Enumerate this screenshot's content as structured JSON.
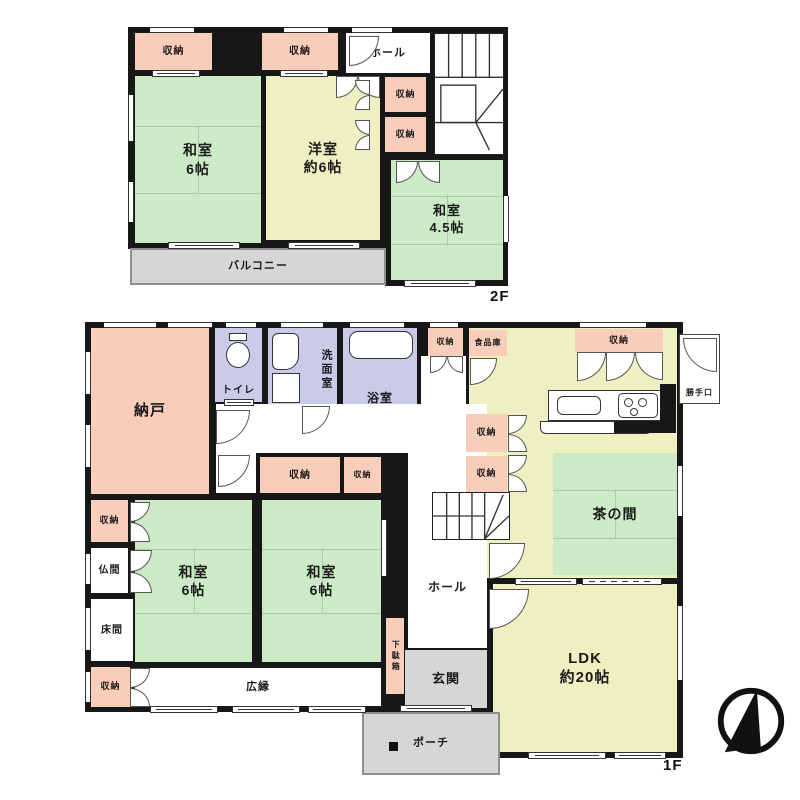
{
  "title": "2階建て住宅 間取り図",
  "colors": {
    "pink": "#f8cdb9",
    "green": "#cdeac6",
    "yellow": "#eef0c1",
    "lav": "#c9cbe9",
    "gray": "#d6d6d6",
    "white": "#ffffff",
    "wall": "#171717"
  },
  "floors": [
    {
      "id": "2f",
      "floor_label": "2F",
      "label_pos": {
        "x": 490,
        "y": 288
      },
      "body": [
        [
          128,
          27,
          380,
          222
        ],
        [
          385,
          27,
          123,
          259
        ]
      ],
      "rooms": [
        {
          "name": "closet",
          "label": "収納",
          "fill": "pink",
          "x": 135,
          "y": 33,
          "w": 77,
          "h": 37,
          "fs": 10
        },
        {
          "name": "closet",
          "label": "収納",
          "fill": "pink",
          "x": 262,
          "y": 33,
          "w": 76,
          "h": 37,
          "fs": 10
        },
        {
          "name": "hall",
          "label": "ホール",
          "fill": "white",
          "x": 346,
          "y": 33,
          "w": 84,
          "h": 40,
          "fs": 11
        },
        {
          "name": "closet",
          "label": "収納",
          "fill": "pink",
          "x": 385,
          "y": 77,
          "w": 41,
          "h": 35,
          "fs": 9
        },
        {
          "name": "closet",
          "label": "収納",
          "fill": "pink",
          "x": 385,
          "y": 117,
          "w": 41,
          "h": 35,
          "fs": 9
        },
        {
          "name": "tatami-room-6",
          "label": "和室",
          "label2": "6帖",
          "fill": "green",
          "x": 135,
          "y": 76,
          "w": 126,
          "h": 167,
          "fs": 14,
          "mats": true
        },
        {
          "name": "western-room-6",
          "label": "洋室",
          "label2": "約6帖",
          "fill": "yellow",
          "x": 266,
          "y": 76,
          "w": 114,
          "h": 164,
          "fs": 14
        },
        {
          "name": "tatami-room-4-5",
          "label": "和室",
          "label2": "4.5帖",
          "fill": "green",
          "x": 391,
          "y": 160,
          "w": 112,
          "h": 120,
          "fs": 13,
          "mats": true
        },
        {
          "name": "balcony",
          "label": "バルコニー",
          "fill": "gray",
          "x": 130,
          "y": 248,
          "w": 256,
          "h": 37,
          "fs": 11,
          "thin": true
        }
      ],
      "fixtures": [
        [
          "stairs",
          434,
          33,
          70,
          122,
          "s2f"
        ],
        [
          "win-h",
          150,
          27,
          44
        ],
        [
          "win-h",
          284,
          27,
          44
        ],
        [
          "win-h",
          352,
          27,
          40
        ],
        [
          "win-v",
          128,
          95,
          46
        ],
        [
          "win-v",
          128,
          182,
          40
        ],
        [
          "win-v",
          503,
          196,
          46
        ],
        [
          "slide-h",
          168,
          242,
          72
        ],
        [
          "slide-h",
          288,
          242,
          72
        ],
        [
          "slide-h",
          404,
          280,
          72
        ],
        [
          "slide-h",
          152,
          70,
          48
        ],
        [
          "slide-h",
          280,
          70,
          48
        ],
        [
          "arc",
          349,
          36,
          30,
          "tl"
        ],
        [
          "dbl",
          336,
          76,
          44,
          "down"
        ],
        [
          "dbl",
          355,
          80,
          30,
          "left"
        ],
        [
          "dbl",
          355,
          120,
          30,
          "left"
        ],
        [
          "dbl",
          396,
          161,
          44,
          "down"
        ]
      ]
    },
    {
      "id": "1f",
      "floor_label": "1F",
      "label_pos": {
        "x": 663,
        "y": 757
      },
      "body": [
        [
          85,
          322,
          340,
          390
        ],
        [
          425,
          322,
          258,
          256
        ],
        [
          487,
          578,
          196,
          180
        ],
        [
          425,
          578,
          62,
          134
        ]
      ],
      "rooms": [
        {
          "name": "kitchen-dining",
          "label": "",
          "fill": "yellow",
          "x": 469,
          "y": 328,
          "w": 208,
          "h": 250
        },
        {
          "name": "storage-room",
          "label": "納戸",
          "fill": "pink",
          "x": 91,
          "y": 328,
          "w": 118,
          "h": 166,
          "fs": 15
        },
        {
          "name": "toilet",
          "label": "トイレ",
          "fill": "lav",
          "x": 215,
          "y": 328,
          "w": 47,
          "h": 74,
          "fs": 10,
          "labelPos": "bottom"
        },
        {
          "name": "washroom",
          "label": "洗面室",
          "fill": "lav",
          "x": 268,
          "y": 328,
          "w": 69,
          "h": 84,
          "fs": 11,
          "vertical": true,
          "labelPos": "right"
        },
        {
          "name": "bathroom",
          "label": "浴室",
          "fill": "lav",
          "x": 343,
          "y": 328,
          "w": 74,
          "h": 84,
          "fs": 12,
          "labelPos": "bottom"
        },
        {
          "name": "closet",
          "label": "収納",
          "fill": "pink",
          "x": 428,
          "y": 328,
          "w": 35,
          "h": 28,
          "fs": 8
        },
        {
          "name": "pantry",
          "label": "食品庫",
          "fill": "pink",
          "x": 469,
          "y": 330,
          "w": 38,
          "h": 26,
          "fs": 8
        },
        {
          "name": "kitchen-closet",
          "label": "収納",
          "fill": "pink",
          "x": 575,
          "y": 329,
          "w": 88,
          "h": 23,
          "fs": 9
        },
        {
          "name": "back-door",
          "label": "勝手口",
          "fill": "white",
          "x": 679,
          "y": 334,
          "w": 41,
          "h": 70,
          "fs": 8,
          "outline": true,
          "labelPos": "bottom"
        },
        {
          "name": "hall-corridor",
          "label": "",
          "fill": "white",
          "x": 421,
          "y": 356,
          "w": 45,
          "h": 50
        },
        {
          "name": "hall-corridor",
          "label": "",
          "fill": "white",
          "x": 216,
          "y": 404,
          "w": 192,
          "h": 49
        },
        {
          "name": "hall",
          "label": "ホール",
          "fill": "white",
          "x": 408,
          "y": 404,
          "w": 79,
          "h": 244,
          "fs": 12,
          "ly": 176
        },
        {
          "name": "closet",
          "label": "収納",
          "fill": "pink",
          "x": 466,
          "y": 414,
          "w": 41,
          "h": 38,
          "fs": 9
        },
        {
          "name": "closet",
          "label": "収納",
          "fill": "pink",
          "x": 466,
          "y": 456,
          "w": 41,
          "h": 36,
          "fs": 9
        },
        {
          "name": "tea-room",
          "label": "茶の間",
          "fill": "green",
          "x": 553,
          "y": 453,
          "w": 124,
          "h": 122,
          "fs": 14,
          "mats": true
        },
        {
          "name": "hall-vestibule",
          "label": "",
          "fill": "white",
          "x": 216,
          "y": 453,
          "w": 40,
          "h": 40
        },
        {
          "name": "closet",
          "label": "収納",
          "fill": "pink",
          "x": 260,
          "y": 457,
          "w": 80,
          "h": 36,
          "fs": 10
        },
        {
          "name": "closet",
          "label": "収納",
          "fill": "pink",
          "x": 344,
          "y": 457,
          "w": 37,
          "h": 36,
          "fs": 8
        },
        {
          "name": "closet",
          "label": "収納",
          "fill": "pink",
          "x": 91,
          "y": 500,
          "w": 37,
          "h": 42,
          "fs": 9
        },
        {
          "name": "altar-room",
          "label": "仏間",
          "fill": "white",
          "x": 91,
          "y": 548,
          "w": 37,
          "h": 45,
          "fs": 10
        },
        {
          "name": "alcove",
          "label": "床間",
          "fill": "white",
          "x": 91,
          "y": 599,
          "w": 42,
          "h": 62,
          "fs": 10
        },
        {
          "name": "closet",
          "label": "収納",
          "fill": "pink",
          "x": 91,
          "y": 667,
          "w": 39,
          "h": 40,
          "fs": 9
        },
        {
          "name": "tatami-room-6",
          "label": "和室",
          "label2": "6帖",
          "fill": "green",
          "x": 135,
          "y": 500,
          "w": 117,
          "h": 162,
          "fs": 14,
          "mats": true
        },
        {
          "name": "tatami-room-6",
          "label": "和室",
          "label2": "6帖",
          "fill": "green",
          "x": 262,
          "y": 500,
          "w": 119,
          "h": 162,
          "fs": 14,
          "mats": true
        },
        {
          "name": "veranda",
          "label": "広縁",
          "fill": "white",
          "x": 135,
          "y": 668,
          "w": 246,
          "h": 38,
          "fs": 11
        },
        {
          "name": "shoe-cabinet",
          "label": "下駄箱",
          "fill": "pink",
          "x": 386,
          "y": 618,
          "w": 18,
          "h": 76,
          "fs": 8,
          "vertical": true
        },
        {
          "name": "entrance",
          "label": "玄関",
          "fill": "gray",
          "x": 405,
          "y": 650,
          "w": 82,
          "h": 58,
          "fs": 13
        },
        {
          "name": "ldk",
          "label": "LDK",
          "label2": "約20帖",
          "fill": "yellow",
          "x": 493,
          "y": 584,
          "w": 184,
          "h": 168,
          "fs": 15
        },
        {
          "name": "porch",
          "label": "ポーチ",
          "fill": "gray",
          "x": 362,
          "y": 712,
          "w": 138,
          "h": 63,
          "fs": 11,
          "thin": true
        }
      ],
      "fixtures": [
        [
          "stairs",
          432,
          492,
          78,
          48,
          "s1f"
        ],
        [
          "toilet",
          225,
          333
        ],
        [
          "wm",
          272,
          333
        ],
        [
          "vanity",
          272,
          373
        ],
        [
          "tub",
          349,
          331,
          64,
          28
        ],
        [
          "counter",
          548,
          390,
          114,
          31
        ],
        [
          "sink",
          557,
          396,
          44,
          19
        ],
        [
          "stove",
          618,
          393,
          40,
          25
        ],
        [
          "strip",
          540,
          421,
          112,
          13
        ],
        [
          "wallstub",
          660,
          384,
          16,
          49
        ],
        [
          "wallstub",
          614,
          421,
          62,
          12
        ],
        [
          "arc",
          216,
          410,
          34,
          "tl"
        ],
        [
          "arc",
          218,
          455,
          32,
          "tl"
        ],
        [
          "slide-h",
          224,
          399,
          30
        ],
        [
          "arc",
          302,
          406,
          28,
          "tl"
        ],
        [
          "arc",
          470,
          358,
          27,
          "tl"
        ],
        [
          "dbl",
          430,
          356,
          33,
          "down"
        ],
        [
          "arc",
          577,
          352,
          29,
          "tl"
        ],
        [
          "arc",
          606,
          352,
          29,
          "tl"
        ],
        [
          "arc",
          635,
          352,
          28,
          "tr"
        ],
        [
          "arc",
          683,
          338,
          34,
          "tr"
        ],
        [
          "dbl",
          508,
          415,
          37,
          "right"
        ],
        [
          "dbl",
          508,
          455,
          37,
          "right"
        ],
        [
          "arc",
          489,
          543,
          36,
          "tl"
        ],
        [
          "arc",
          489,
          589,
          40,
          "tl"
        ],
        [
          "dbl",
          130,
          502,
          40,
          "right"
        ],
        [
          "dbl",
          130,
          550,
          43,
          "right"
        ],
        [
          "dbl",
          130,
          668,
          39,
          "right"
        ],
        [
          "slide-h",
          400,
          705,
          72
        ],
        [
          "sq",
          389,
          742,
          9
        ],
        [
          "slide-h",
          515,
          578,
          62
        ],
        [
          "dash-h",
          582,
          578,
          80
        ],
        [
          "win-h",
          104,
          322,
          52
        ],
        [
          "win-h",
          168,
          322,
          44
        ],
        [
          "win-h",
          226,
          322,
          30
        ],
        [
          "win-h",
          281,
          322,
          42
        ],
        [
          "win-h",
          350,
          322,
          54
        ],
        [
          "win-h",
          430,
          322,
          28
        ],
        [
          "win-h",
          580,
          322,
          66
        ],
        [
          "win-v",
          85,
          352,
          42
        ],
        [
          "win-v",
          85,
          425,
          42
        ],
        [
          "win-v",
          85,
          554,
          30
        ],
        [
          "win-v",
          85,
          608,
          42
        ],
        [
          "win-v",
          85,
          672,
          30
        ],
        [
          "slide-h",
          150,
          706,
          68
        ],
        [
          "slide-h",
          232,
          706,
          68
        ],
        [
          "slide-h",
          308,
          706,
          58
        ],
        [
          "win-v",
          677,
          466,
          50
        ],
        [
          "win-v",
          677,
          606,
          74
        ],
        [
          "win-v",
          381,
          520,
          56
        ],
        [
          "slide-h",
          528,
          752,
          78
        ],
        [
          "slide-h",
          614,
          752,
          52
        ]
      ]
    }
  ],
  "compass": {
    "meaning": "north-arrow",
    "x": 712,
    "y": 682,
    "size": 78
  }
}
